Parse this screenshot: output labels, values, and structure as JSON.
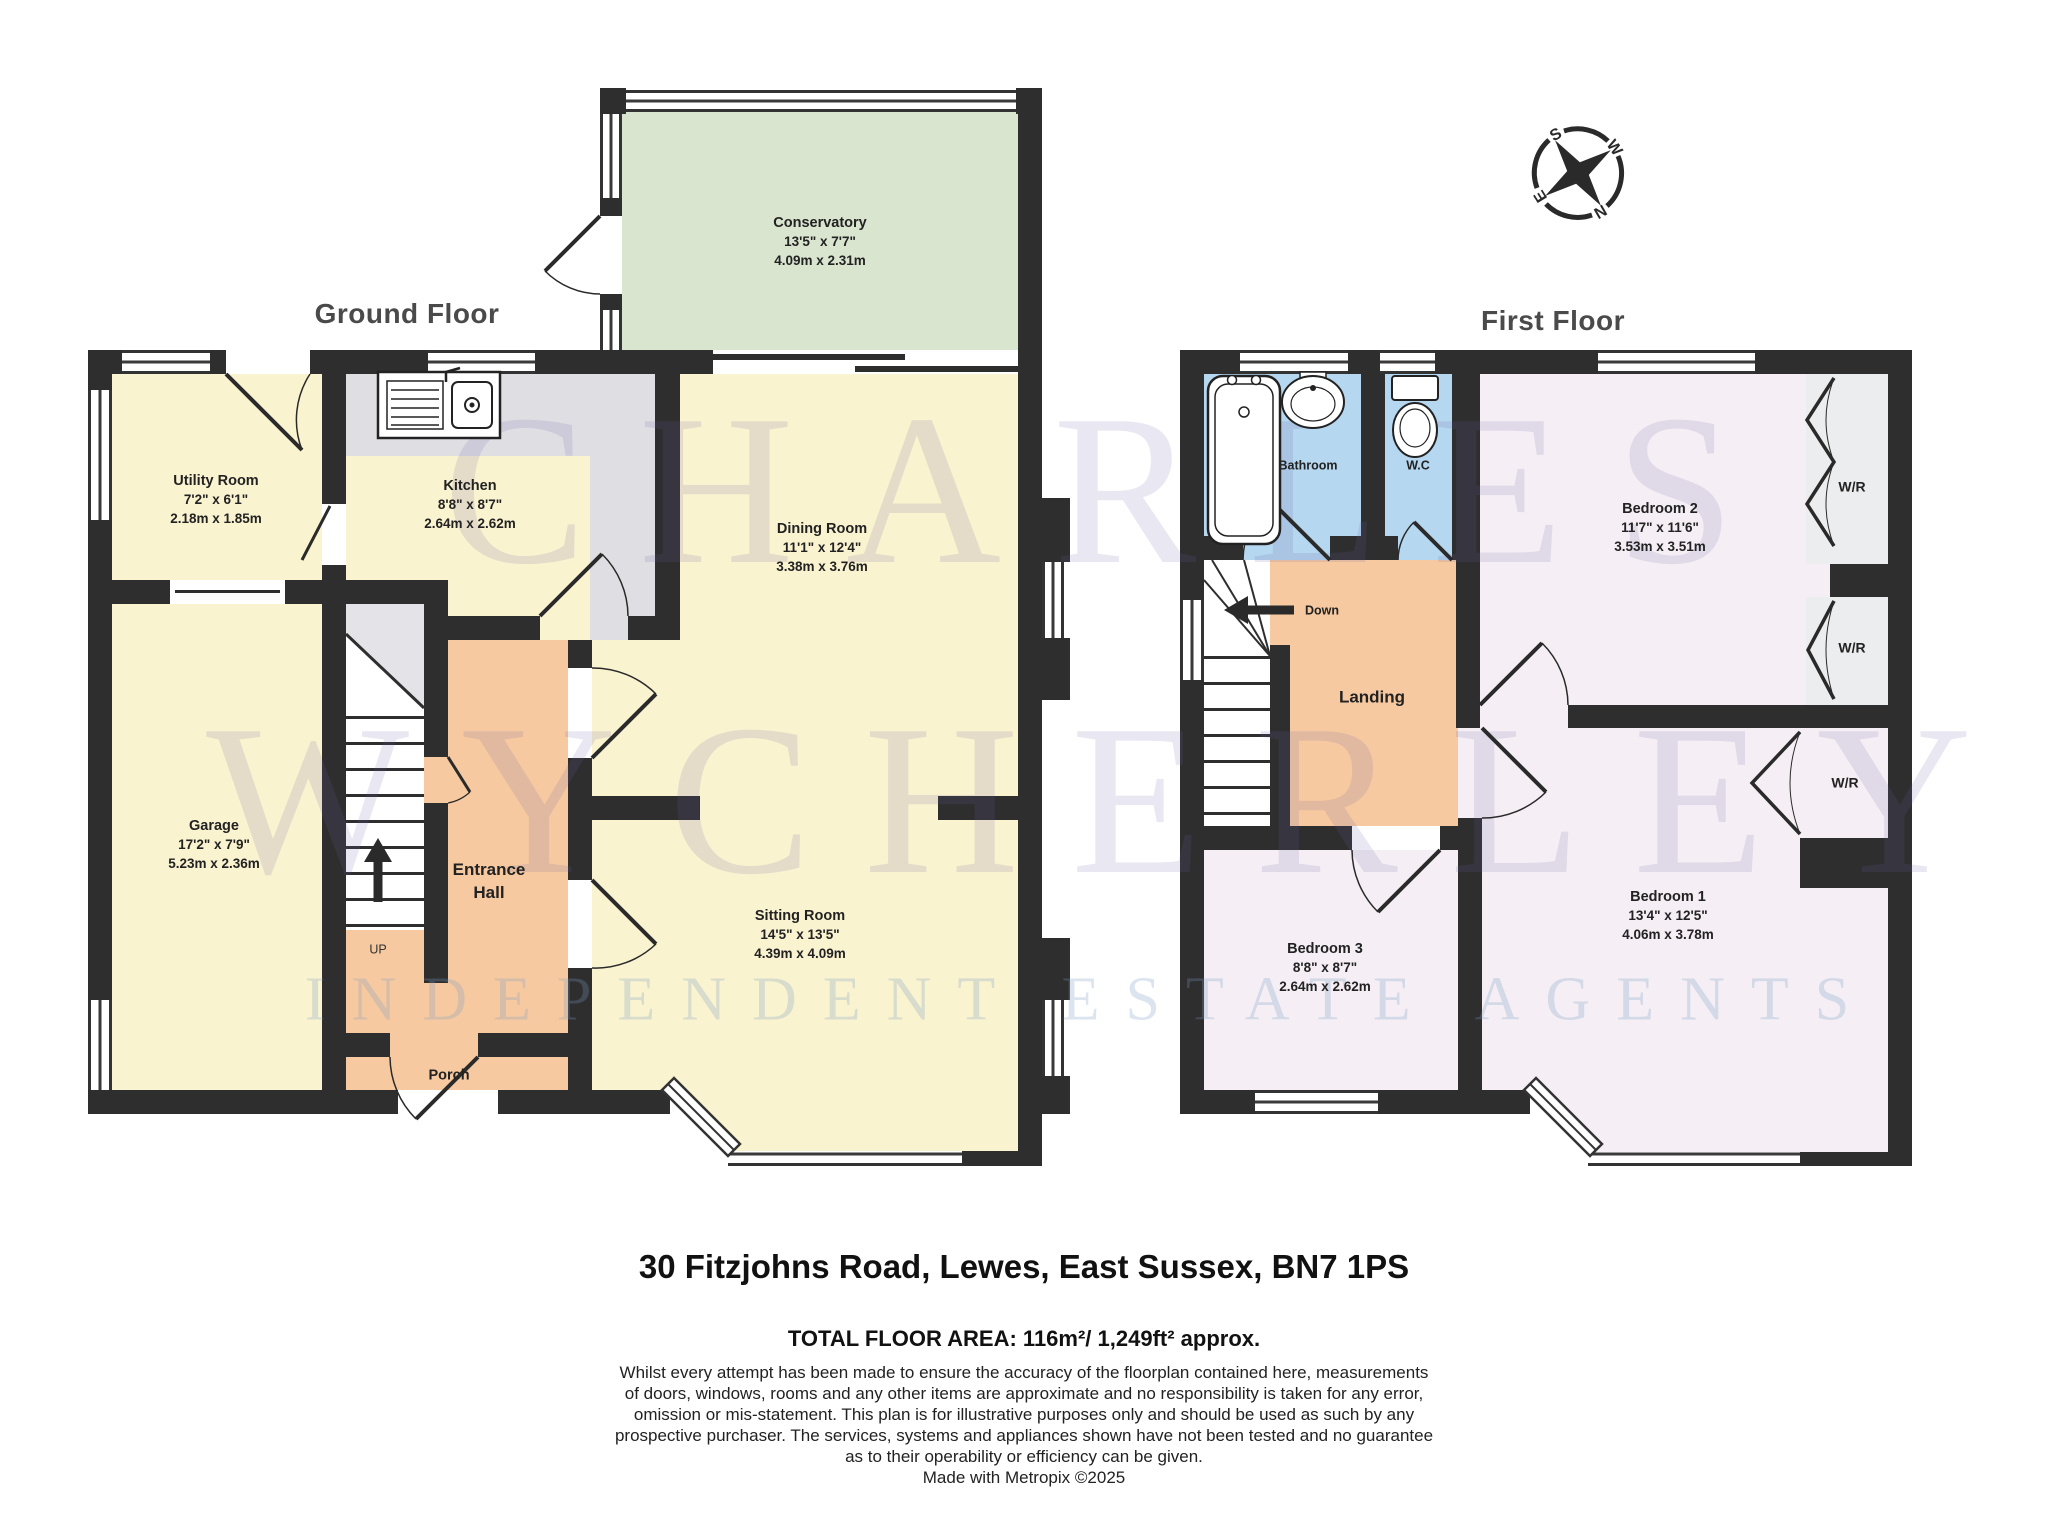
{
  "ground_floor": {
    "title": "Ground Floor",
    "stairs_label": "UP",
    "rooms": {
      "conservatory": {
        "name": "Conservatory",
        "imperial": "13'5\" x 7'7\"",
        "metric": "4.09m x 2.31m"
      },
      "utility": {
        "name": "Utility Room",
        "imperial": "7'2\" x 6'1\"",
        "metric": "2.18m x 1.85m"
      },
      "kitchen": {
        "name": "Kitchen",
        "imperial": "8'8\" x 8'7\"",
        "metric": "2.64m x 2.62m"
      },
      "dining": {
        "name": "Dining Room",
        "imperial": "11'1\" x 12'4\"",
        "metric": "3.38m x 3.76m"
      },
      "garage": {
        "name": "Garage",
        "imperial": "17'2\" x 7'9\"",
        "metric": "5.23m x 2.36m"
      },
      "hall": {
        "line1": "Entrance",
        "line2": "Hall"
      },
      "porch": {
        "name": "Porch"
      },
      "sitting": {
        "name": "Sitting Room",
        "imperial": "14'5\" x 13'5\"",
        "metric": "4.39m x 4.09m"
      }
    }
  },
  "first_floor": {
    "title": "First Floor",
    "stairs_label": "Down",
    "wardrobe_label": "W/R",
    "rooms": {
      "bathroom": {
        "name": "Bathroom"
      },
      "wc": {
        "name": "W.C"
      },
      "bedroom2": {
        "name": "Bedroom 2",
        "imperial": "11'7\" x 11'6\"",
        "metric": "3.53m x 3.51m"
      },
      "landing": {
        "name": "Landing"
      },
      "bedroom3": {
        "name": "Bedroom 3",
        "imperial": "8'8\" x 8'7\"",
        "metric": "2.64m x 2.62m"
      },
      "bedroom1": {
        "name": "Bedroom 1",
        "imperial": "13'4\" x 12'5\"",
        "metric": "4.06m x 3.78m"
      }
    }
  },
  "compass": {
    "n": "N",
    "s": "S",
    "e": "E",
    "w": "W"
  },
  "watermark": {
    "line1": "CHARLES",
    "line2": "WYCHERLEY",
    "line3": "INDEPENDENT ESTATE AGENTS"
  },
  "footer": {
    "address": "30 Fitzjohns Road, Lewes, East Sussex, BN7 1PS",
    "total_area": "TOTAL FLOOR AREA: 116m²/ 1,249ft² approx.",
    "disclaimer": [
      "Whilst every attempt has been made to ensure the accuracy of the floorplan contained here, measurements",
      "of doors, windows, rooms and any other items are approximate and no responsibility is taken for any error,",
      "omission or mis-statement. This plan is for illustrative purposes only and should be used as such by any",
      "prospective purchaser. The services, systems and appliances shown have not been tested and no guarantee",
      "as to their operability or efficiency can be given."
    ],
    "credit": "Made with Metropix ©2025"
  },
  "colors": {
    "wall": "#2e2e2e",
    "room_yellow": "#FAF3D0",
    "conservatory_green": "#D9E5CF",
    "hall_orange": "#F6C9A0",
    "bath_blue": "#B6D7F0",
    "bedroom_pink": "#F5EFF5",
    "counter_grey": "#DFDFE3",
    "wardrobe_grey": "#ECEDEF"
  }
}
